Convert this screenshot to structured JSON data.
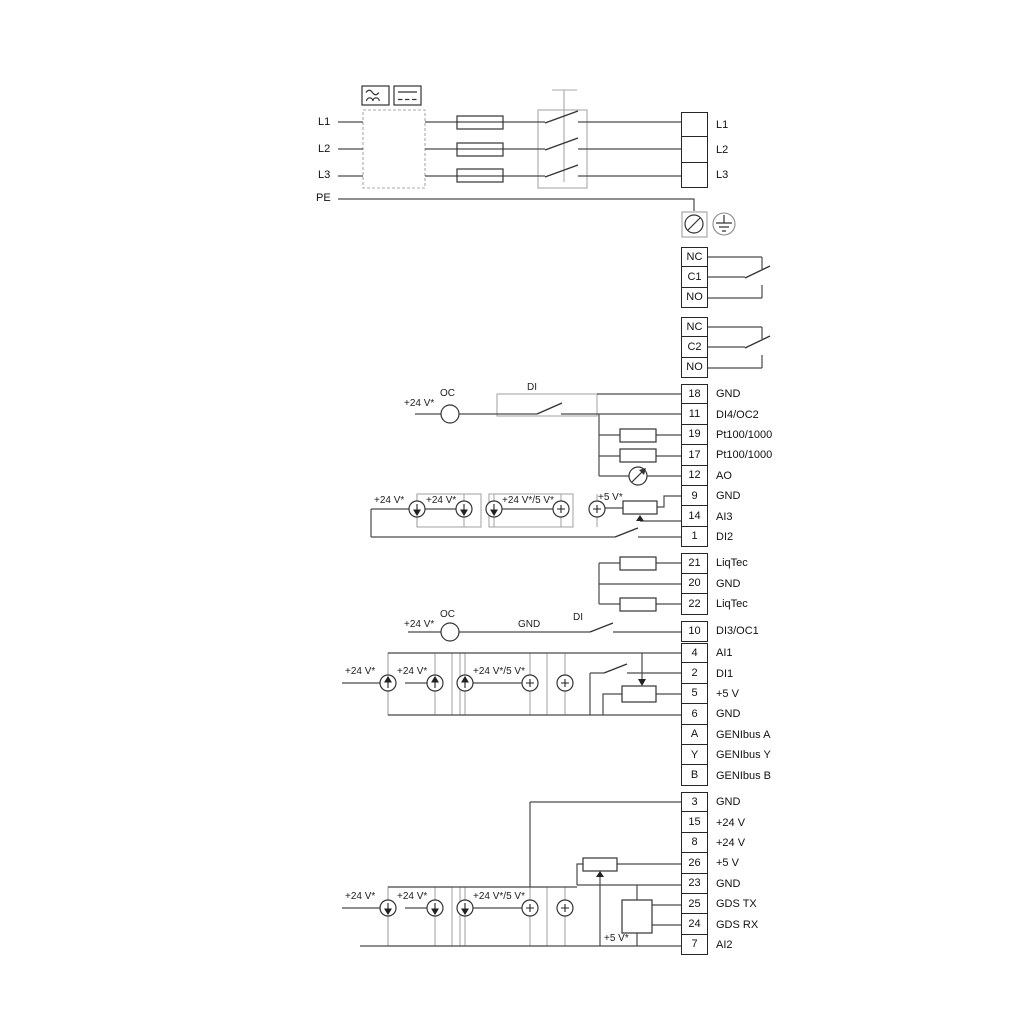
{
  "power": {
    "inputs": [
      "L1",
      "L2",
      "L3",
      "PE"
    ],
    "outputs": [
      "L1",
      "L2",
      "L3"
    ]
  },
  "relays": {
    "r1": [
      "NC",
      "C1",
      "NO"
    ],
    "r2": [
      "NC",
      "C2",
      "NO"
    ]
  },
  "strips": {
    "a": [
      {
        "num": "18",
        "label": "GND"
      },
      {
        "num": "11",
        "label": "DI4/OC2"
      },
      {
        "num": "19",
        "label": "Pt100/1000"
      },
      {
        "num": "17",
        "label": "Pt100/1000"
      },
      {
        "num": "12",
        "label": "AO"
      },
      {
        "num": "9",
        "label": "GND"
      },
      {
        "num": "14",
        "label": "AI3"
      },
      {
        "num": "1",
        "label": "DI2"
      }
    ],
    "liq": [
      {
        "num": "21",
        "label": "LiqTec"
      },
      {
        "num": "20",
        "label": "GND"
      },
      {
        "num": "22",
        "label": "LiqTec"
      }
    ],
    "d10": {
      "num": "10",
      "label": "DI3/OC1"
    },
    "b": [
      {
        "num": "4",
        "label": "AI1"
      },
      {
        "num": "2",
        "label": "DI1"
      },
      {
        "num": "5",
        "label": "+5 V"
      },
      {
        "num": "6",
        "label": "GND"
      },
      {
        "num": "A",
        "label": "GENIbus A"
      },
      {
        "num": "Y",
        "label": "GENIbus Y"
      },
      {
        "num": "B",
        "label": "GENIbus B"
      }
    ],
    "c": [
      {
        "num": "3",
        "label": "GND"
      },
      {
        "num": "15",
        "label": "+24 V"
      },
      {
        "num": "8",
        "label": "+24 V"
      },
      {
        "num": "26",
        "label": "+5 V"
      },
      {
        "num": "23",
        "label": "GND"
      },
      {
        "num": "25",
        "label": "GDS TX"
      },
      {
        "num": "24",
        "label": "GDS RX"
      },
      {
        "num": "7",
        "label": "AI2"
      }
    ]
  },
  "ann": {
    "v24": "+24 V*",
    "v24_5": "+24 V*/5 V*",
    "v5": "+5 V*",
    "oc": "OC",
    "di": "DI",
    "gnd": "GND"
  },
  "colors": {
    "wire": "#4a4a4a",
    "frame": "#a0a0a0",
    "component": "#333333"
  }
}
